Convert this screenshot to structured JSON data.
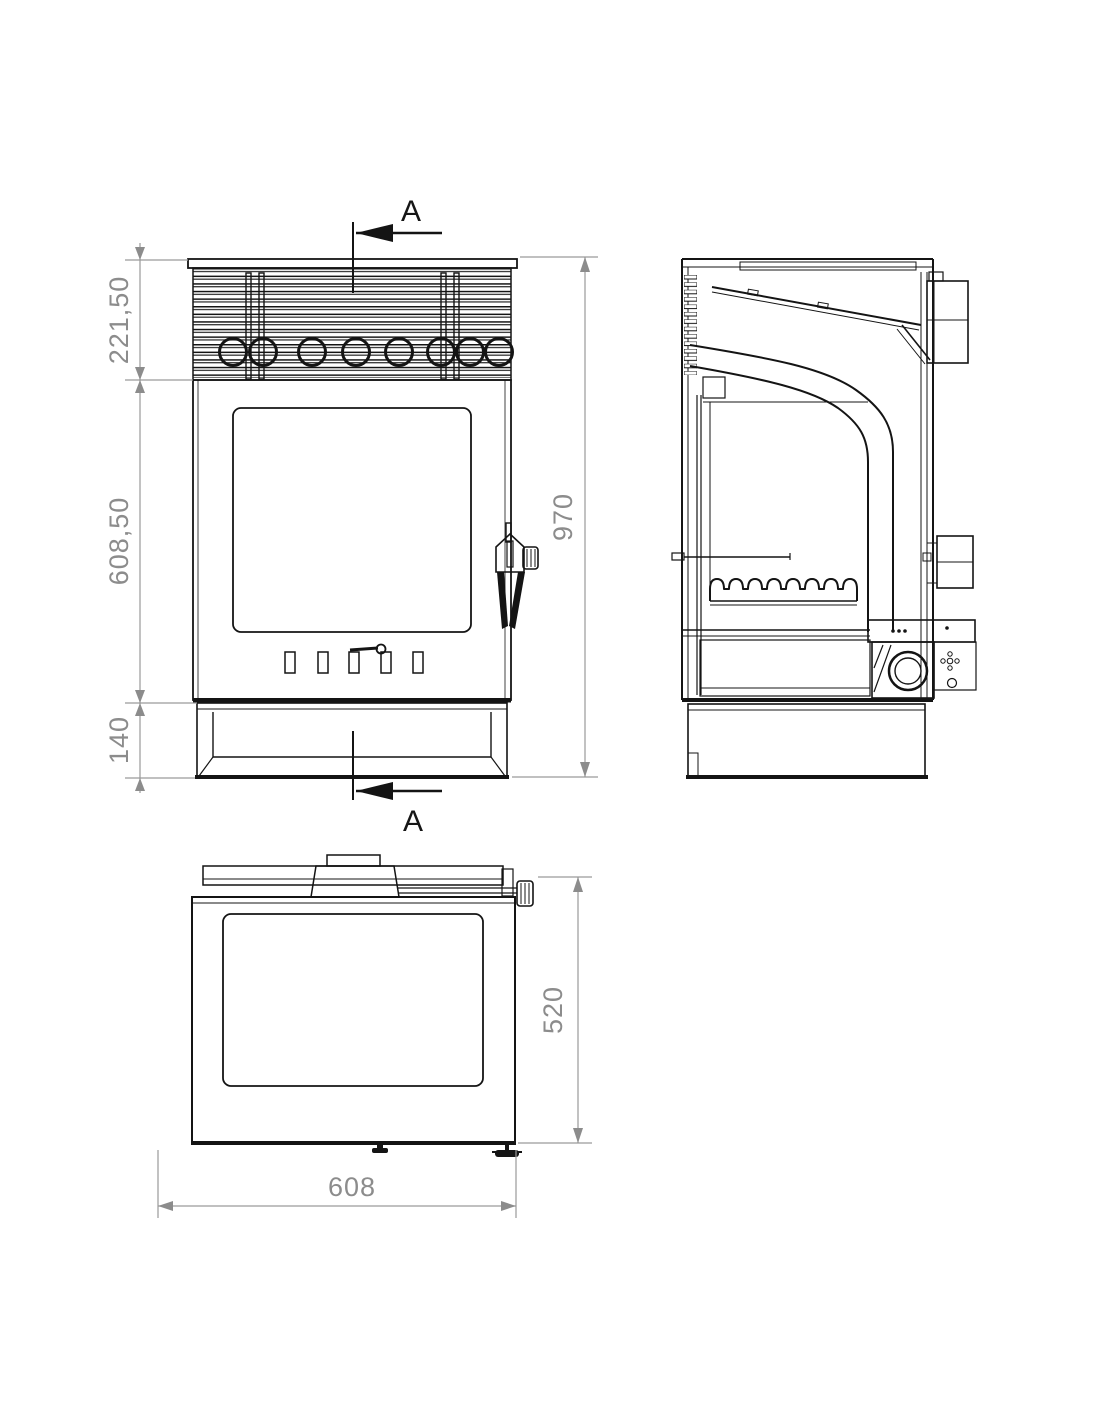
{
  "drawing": {
    "background": "#ffffff",
    "line_color": "#141414",
    "dimension_color": "#8c8c8c",
    "units": "mm"
  },
  "sections": {
    "top": {
      "label": "A"
    },
    "bottom": {
      "label": "A"
    }
  },
  "dims": {
    "front_top": {
      "label": "221,50",
      "value_mm": 221.5
    },
    "front_mid": {
      "label": "608,50",
      "value_mm": 608.5
    },
    "front_base": {
      "label": "140",
      "value_mm": 140
    },
    "front_total": {
      "label": "970",
      "value_mm": 970
    },
    "plan_depth": {
      "label": "520",
      "value_mm": 520
    },
    "plan_width": {
      "label": "608",
      "value_mm": 608
    }
  }
}
